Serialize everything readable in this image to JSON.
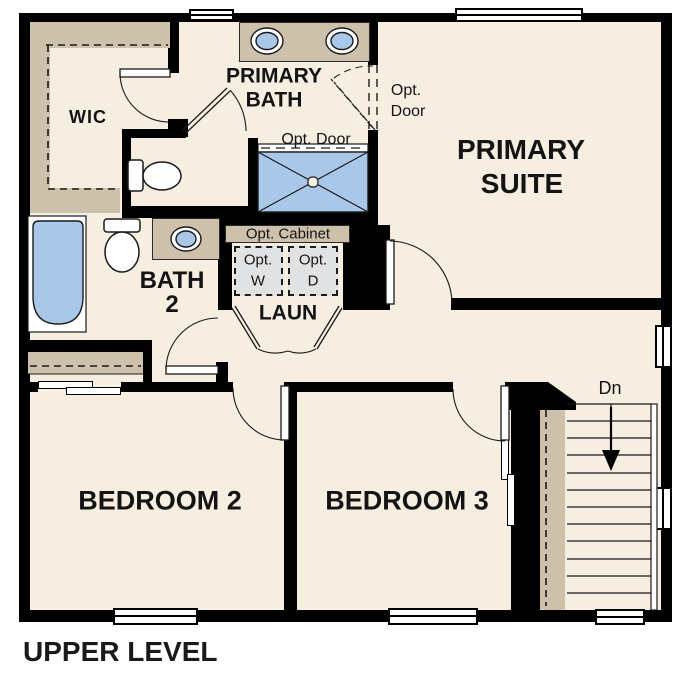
{
  "title": "UPPER LEVEL",
  "colors": {
    "wall": "#000000",
    "floor": "#f6eee1",
    "cabinetry_tan": "#cec1ab",
    "fixture_blue": "#a9c7e8",
    "appliance_gray": "#e0e2e4"
  },
  "rooms": {
    "wic": {
      "label": "WIC"
    },
    "primary_bath": {
      "line1": "PRIMARY",
      "line2": "BATH"
    },
    "primary_suite": {
      "line1": "PRIMARY",
      "line2": "SUITE"
    },
    "bath2": {
      "line1": "BATH",
      "line2": "2"
    },
    "laundry": {
      "label": "LAUN"
    },
    "bedroom2": {
      "label": "BEDROOM 2"
    },
    "bedroom3": {
      "label": "BEDROOM 3"
    }
  },
  "annotations": {
    "opt_door_suite": {
      "line1": "Opt.",
      "line2": "Door"
    },
    "opt_door_shower": {
      "label": "Opt. Door"
    },
    "opt_cabinet": {
      "label": "Opt. Cabinet"
    },
    "opt_washer": {
      "line1": "Opt.",
      "line2": "W"
    },
    "opt_dryer": {
      "line1": "Opt.",
      "line2": "D"
    },
    "stairs_down": {
      "label": "Dn"
    }
  }
}
